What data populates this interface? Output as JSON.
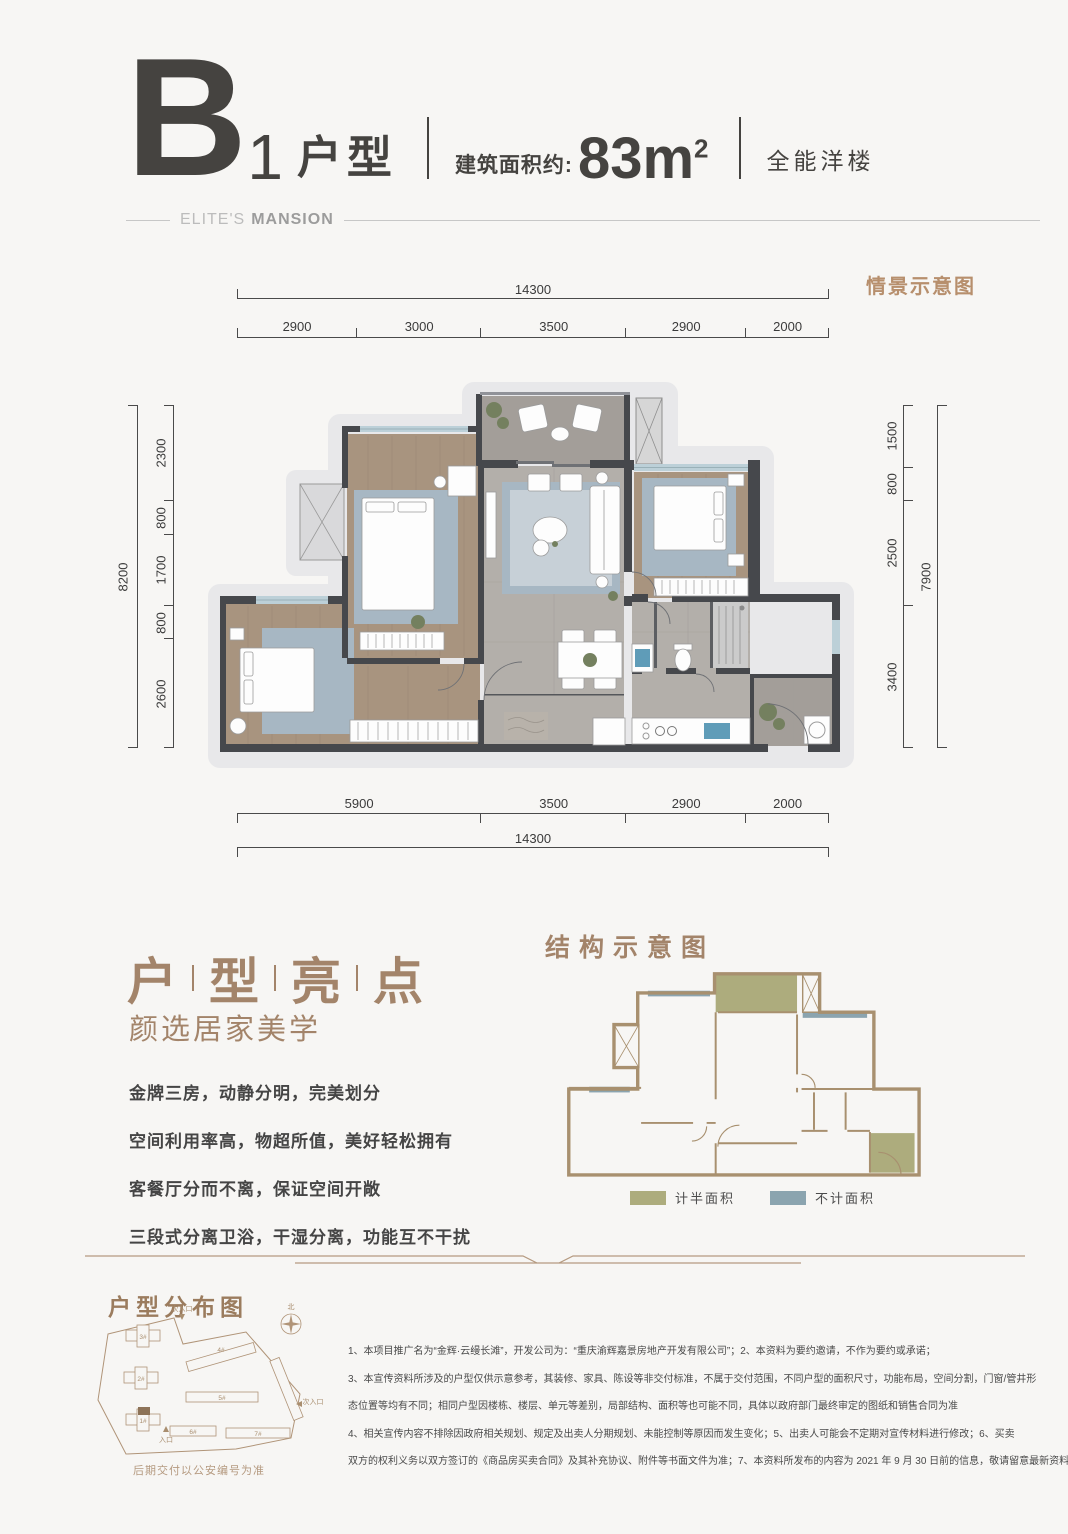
{
  "header": {
    "unit_letter": "B",
    "unit_number": "1",
    "unit_suffix": "户型",
    "area_label": "建筑面积约:",
    "area_value": "83m",
    "area_sup": "2",
    "tagline": "全能洋楼",
    "brand_light": "ELITE'S",
    "brand_bold": "MANSION"
  },
  "plan": {
    "scene_label": "情景示意图",
    "dims_top_total": "14300",
    "dims_top": [
      "2900",
      "3000",
      "3500",
      "2900",
      "2000"
    ],
    "dims_bottom": [
      "5900",
      "3500",
      "2900",
      "2000"
    ],
    "dims_bottom_total": "14300",
    "dims_left_total": "8200",
    "dims_left": [
      "2300",
      "800",
      "1700",
      "800",
      "2600"
    ],
    "dims_right": [
      "1500",
      "800",
      "2500",
      "3400"
    ],
    "dims_right_total": "7900"
  },
  "highlights": {
    "title_chars": [
      "户",
      "型",
      "亮",
      "点"
    ],
    "subtitle": "颜选居家美学",
    "points": [
      "金牌三房，动静分明，完美划分",
      "空间利用率高，物超所值，美好轻松拥有",
      "客餐厅分而不离，保证空间开敞",
      "三段式分离卫浴，干湿分离，功能互不干扰"
    ]
  },
  "structure": {
    "title": "结构示意图",
    "legend": [
      {
        "label": "计半面积",
        "color": "#adac7d"
      },
      {
        "label": "不计面积",
        "color": "#8ba4af"
      }
    ]
  },
  "siteplan": {
    "title": "户型分布图",
    "caption": "后期交付以公安编号为准",
    "north_label": "北",
    "entrance_main": "入口",
    "entrance_secondary": "次入口",
    "buildings": [
      "1#",
      "2#",
      "3#",
      "4#",
      "5#",
      "6#",
      "7#"
    ]
  },
  "disclaimer": {
    "lines": [
      "1、本项目推广名为“金辉·云缦长滩”，开发公司为：“重庆渝辉嘉景房地产开发有限公司”；2、本资料为要约邀请，不作为要约或承诺；",
      "3、本宣传资料所涉及的户型仅供示意参考，其装修、家具、陈设等非交付标准，不属于交付范围，不同户型的面积尺寸，功能布局，空间分割，门窗/管井形",
      "态位置等均有不同；相同户型因楼栋、楼层、单元等差别，局部结构、面积等也可能不同，具体以政府部门最终审定的图纸和销售合同为准",
      "4、相关宣传内容不排除因政府相关规划、规定及出卖人分期规划、未能控制等原因而发生变化；5、出卖人可能会不定期对宣传材料进行修改；6、买卖",
      "双方的权利义务以双方签订的《商品房买卖合同》及其补充协议、附件等书面文件为准；7、本资料所发布的内容为 2021 年 9 月 30 日前的信息，敬请留意最新资料。"
    ]
  },
  "colors": {
    "accent_tan": "#b78f6d",
    "title_brown": "#a3846a",
    "dark_text": "#454340",
    "half_area": "#adac7d",
    "no_count_area": "#8ba4af"
  }
}
